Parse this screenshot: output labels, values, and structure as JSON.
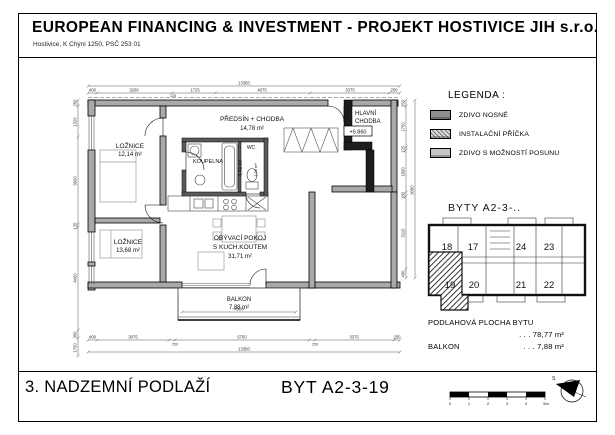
{
  "header": {
    "title": "EUROPEAN FINANCING & INVESTMENT - PROJEKT HOSTIVICE JIH s.r.o.",
    "address": "Hostivice, K Chýni 1250, PSČ 253 01"
  },
  "plan": {
    "rooms": {
      "loznice1_name": "LOŽNICE",
      "loznice1_area": "12,14 m²",
      "loznice2_name": "LOŽNICE",
      "loznice2_area": "13,68 m²",
      "predsin_name": "PŘEDSÍN + CHODBA",
      "predsin_area": "14,78 m²",
      "koupelna_name": "KOUPELNA",
      "koupelna_area": "4,41 m²",
      "wc_name": "WC",
      "wc_area": "1,55 m²",
      "obyvaci_line1": "OBÝVACÍ POKOJ",
      "obyvaci_line2": "S KUCH.KOUTEM",
      "obyvaci_area": "31,71 m²",
      "balkon_name": "BALKON",
      "balkon_area": "7,88 m²",
      "chodba_line1": "HLAVNÍ",
      "chodba_line2": "CHODBA",
      "level_mark": "+5.860"
    },
    "dims": {
      "top_overall": "13350",
      "top": [
        "400",
        "3200",
        "125",
        "1725",
        "4075",
        "3375",
        "250"
      ],
      "bottom": [
        "400",
        "3075",
        "250",
        "5750",
        "250",
        "3375",
        "250"
      ],
      "bottom_overall": "13350",
      "left": [
        "250",
        "1325",
        "3600",
        "125",
        "4400",
        "350",
        "1750"
      ],
      "right": [
        "250",
        "1750",
        "125",
        "1800",
        "180",
        "3115",
        "400"
      ],
      "right_overall": "9080",
      "balcony": "4300"
    }
  },
  "legend": {
    "title": "LEGENDA :",
    "items": [
      {
        "label": "ZDIVO NOSNÉ"
      },
      {
        "label": "INSTALAČNÍ PŘÍČKA"
      },
      {
        "label": "ZDIVO S MOŽNOSTÍ POSUNU"
      }
    ]
  },
  "keyplan": {
    "title": "BYTY  A2-3-..",
    "units": [
      "18",
      "17",
      "24",
      "23",
      "19",
      "20",
      "21",
      "22"
    ],
    "highlighted_unit": "19"
  },
  "areas": {
    "floor_label": "PODLAHOVÁ PLOCHA BYTU",
    "floor_value": ". . .  78,77 m²",
    "balcony_label": "BALKON",
    "balcony_value": ". . .   7,88 m²"
  },
  "footer": {
    "floor_title": "3. NADZEMNÍ PODLAŽÍ",
    "unit_title": "BYT  A2-3-19",
    "scale_ticks": [
      "0",
      "1",
      "2",
      "3",
      "4",
      "5m"
    ],
    "north_label": "S"
  }
}
